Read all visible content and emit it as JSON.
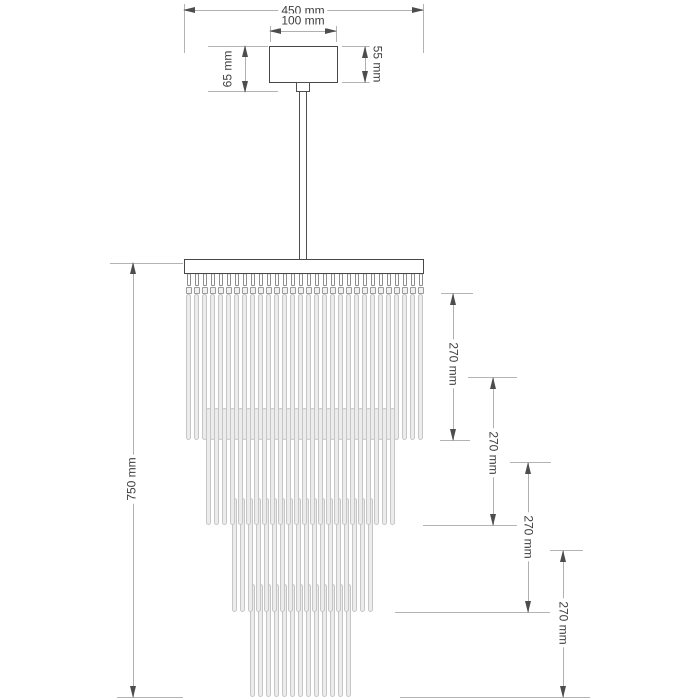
{
  "dims": {
    "overall_width": "450 mm",
    "canopy_width": "100 mm",
    "canopy_height_left": "65 mm",
    "canopy_height_right": "55 mm",
    "overall_height": "750 mm",
    "tier_drops": [
      "270 mm",
      "270 mm",
      "270 mm",
      "270 mm"
    ]
  },
  "figure": {
    "plate": {
      "x": 184,
      "y": 259,
      "width": 240,
      "height": 15
    },
    "canopy": {
      "x": 269,
      "y": 46,
      "width": 69,
      "height": 37
    },
    "tiers": [
      {
        "rods": 30,
        "x0": 186,
        "pitch": 8,
        "rod_width": 5,
        "top": 294,
        "bottom": 440,
        "hooks": true
      },
      {
        "rods": 24,
        "x0": 206,
        "pitch": 8,
        "rod_width": 5,
        "top": 408,
        "bottom": 525,
        "hooks": false
      },
      {
        "rods": 18,
        "x0": 232,
        "pitch": 8,
        "rod_width": 5,
        "top": 498,
        "bottom": 612,
        "hooks": false
      },
      {
        "rods": 13,
        "x0": 250,
        "pitch": 8,
        "rod_width": 5,
        "top": 584,
        "bottom": 697,
        "hooks": false
      }
    ]
  }
}
